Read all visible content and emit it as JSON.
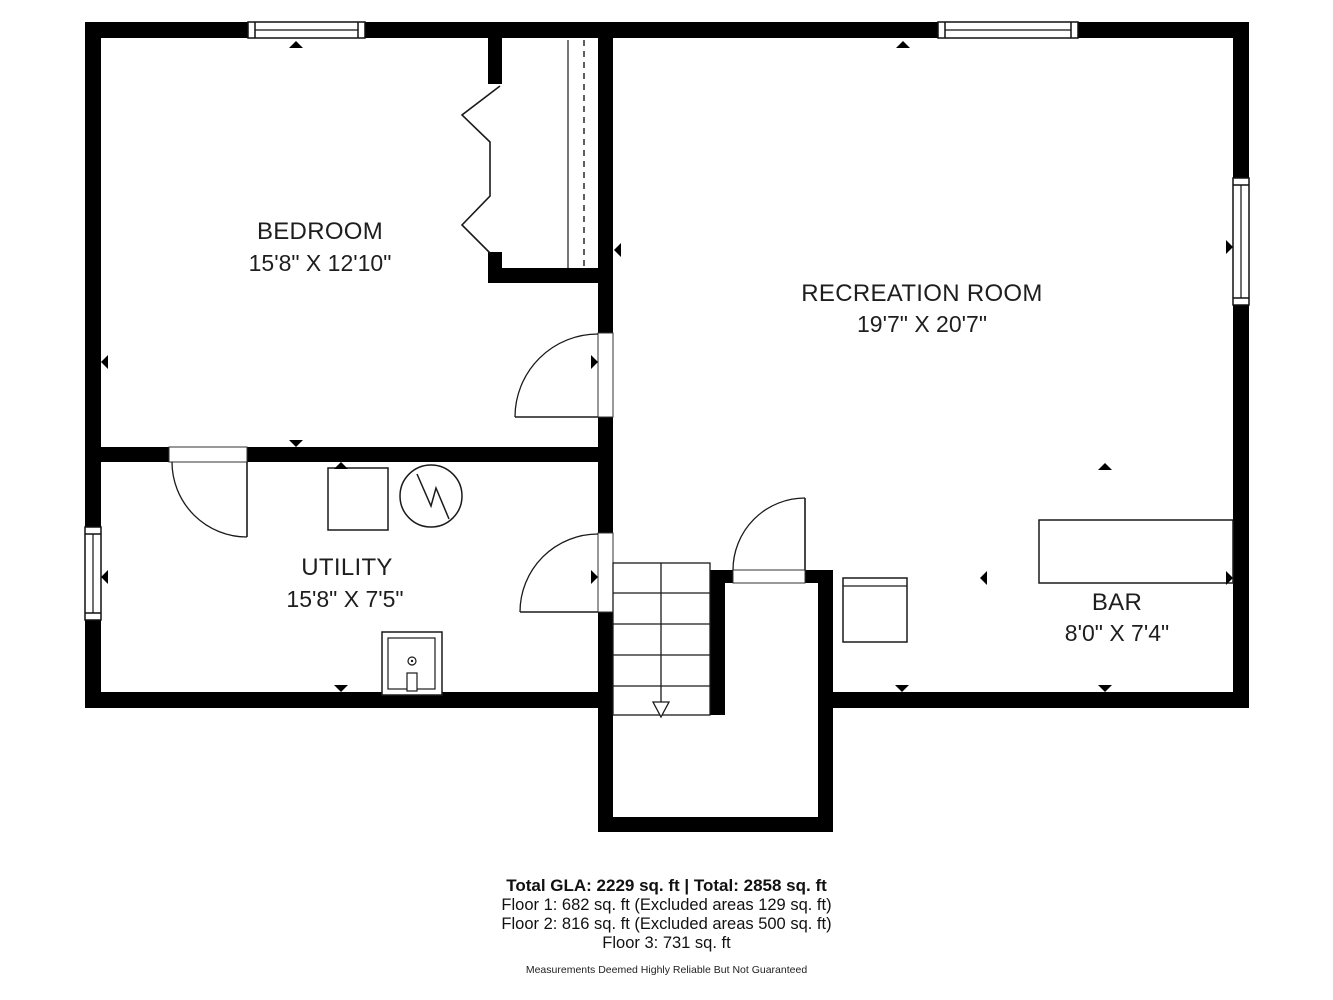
{
  "title": "Basement floor plan",
  "rooms": [
    {
      "id": "bedroom",
      "name": "BEDROOM",
      "dims": "15'8\" X 12'10\""
    },
    {
      "id": "recreation",
      "name": "RECREATION ROOM",
      "dims": "19'7\" X 20'7\""
    },
    {
      "id": "utility",
      "name": "UTILITY",
      "dims": "15'8\" X 7'5\""
    },
    {
      "id": "bar",
      "name": "BAR",
      "dims": "8'0\" X 7'4\""
    }
  ],
  "footer": {
    "total": "Total GLA: 2229 sq. ft | Total: 2858 sq. ft",
    "floor1": "Floor 1: 682 sq. ft (Excluded areas 129 sq. ft)",
    "floor2": "Floor 2: 816 sq. ft (Excluded areas 500 sq. ft)",
    "floor3": "Floor 3: 731 sq. ft",
    "disclaimer": "Measurements Deemed Highly Reliable But Not Guaranteed"
  },
  "symbols": {
    "stairs_direction": "down-arrow",
    "furnace": "circle-with-bolt",
    "laundry_sink": "square-basin",
    "bifold_closet_doors": "zigzag",
    "dimension_markers": "small-triangles"
  },
  "colors": {
    "wall": "#000000",
    "line": "#1a1a1a",
    "text": "#1e1e1e",
    "background": "#ffffff"
  }
}
